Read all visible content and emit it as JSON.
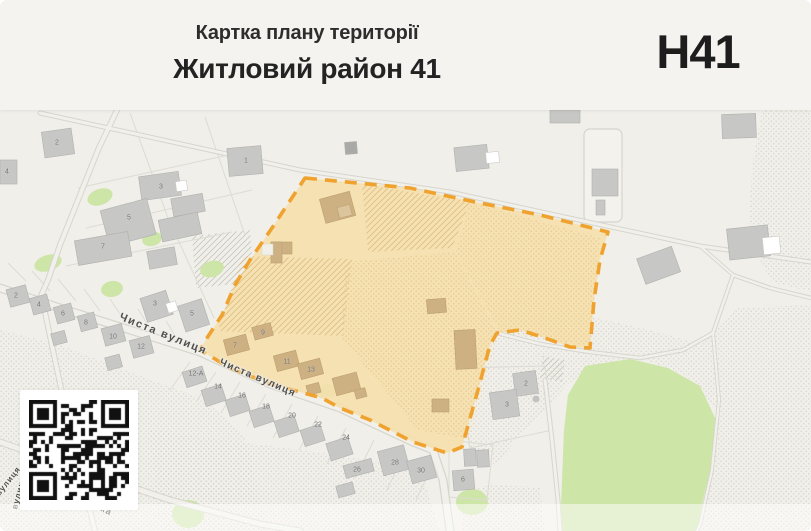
{
  "header": {
    "subtitle": "Картка плану території",
    "title": "Житловий район 41",
    "zone_code": "Н41"
  },
  "map": {
    "street_labels": [
      {
        "text": "Чиста вулиця",
        "x": 122,
        "y": 311,
        "rotate": 22,
        "size": 11,
        "spacing": 1.6
      },
      {
        "text": "Чиста вулиця",
        "x": 222,
        "y": 357,
        "rotate": 23,
        "size": 10,
        "spacing": 1.2
      },
      {
        "text": "Козацька",
        "x": 70,
        "y": 487,
        "rotate": 26,
        "size": 9,
        "spacing": 1
      },
      {
        "text": "вулиця",
        "x": -6,
        "y": 492,
        "rotate": -52,
        "size": 8,
        "spacing": 1
      },
      {
        "text": "вулиця",
        "x": 10,
        "y": 508,
        "rotate": -75,
        "size": 8,
        "spacing": 1
      }
    ],
    "house_numbers": [
      {
        "n": "2",
        "x": 57,
        "y": 143
      },
      {
        "n": "1",
        "x": 246,
        "y": 161
      },
      {
        "n": "4",
        "x": 7,
        "y": 172
      },
      {
        "n": "3",
        "x": 161,
        "y": 187
      },
      {
        "n": "5",
        "x": 129,
        "y": 218
      },
      {
        "n": "7",
        "x": 103,
        "y": 247
      },
      {
        "n": "2",
        "x": 16,
        "y": 296
      },
      {
        "n": "4",
        "x": 39,
        "y": 305
      },
      {
        "n": "6",
        "x": 63,
        "y": 314
      },
      {
        "n": "8",
        "x": 86,
        "y": 323
      },
      {
        "n": "10",
        "x": 113,
        "y": 337
      },
      {
        "n": "12",
        "x": 141,
        "y": 347
      },
      {
        "n": "3",
        "x": 155,
        "y": 304
      },
      {
        "n": "5",
        "x": 192,
        "y": 314
      },
      {
        "n": "12-А",
        "x": 196,
        "y": 374
      },
      {
        "n": "14",
        "x": 218,
        "y": 387
      },
      {
        "n": "16",
        "x": 242,
        "y": 396
      },
      {
        "n": "18",
        "x": 266,
        "y": 407
      },
      {
        "n": "20",
        "x": 292,
        "y": 416
      },
      {
        "n": "22",
        "x": 318,
        "y": 425
      },
      {
        "n": "24",
        "x": 346,
        "y": 438
      },
      {
        "n": "26",
        "x": 357,
        "y": 470
      },
      {
        "n": "28",
        "x": 395,
        "y": 463
      },
      {
        "n": "30",
        "x": 421,
        "y": 471
      },
      {
        "n": "7",
        "x": 235,
        "y": 346
      },
      {
        "n": "9",
        "x": 263,
        "y": 333
      },
      {
        "n": "11",
        "x": 287,
        "y": 362
      },
      {
        "n": "13",
        "x": 311,
        "y": 370
      },
      {
        "n": "2",
        "x": 526,
        "y": 384
      },
      {
        "n": "3",
        "x": 507,
        "y": 405
      },
      {
        "n": "6",
        "x": 463,
        "y": 480
      }
    ],
    "colors": {
      "page_bg": "#f4f3ef",
      "map_bg": "#f0efe9",
      "zone_fill": "#f5e0ad",
      "zone_border": "#f0a22e",
      "road_fill": "#f1f0ea",
      "road_casing": "#d6d5ce",
      "building_gray": "#c7c7c5",
      "building_tan": "#cdb183",
      "green": "#cde5a6",
      "label_gray": "#6f6f6f",
      "street_label": "#4e4e4e"
    }
  }
}
